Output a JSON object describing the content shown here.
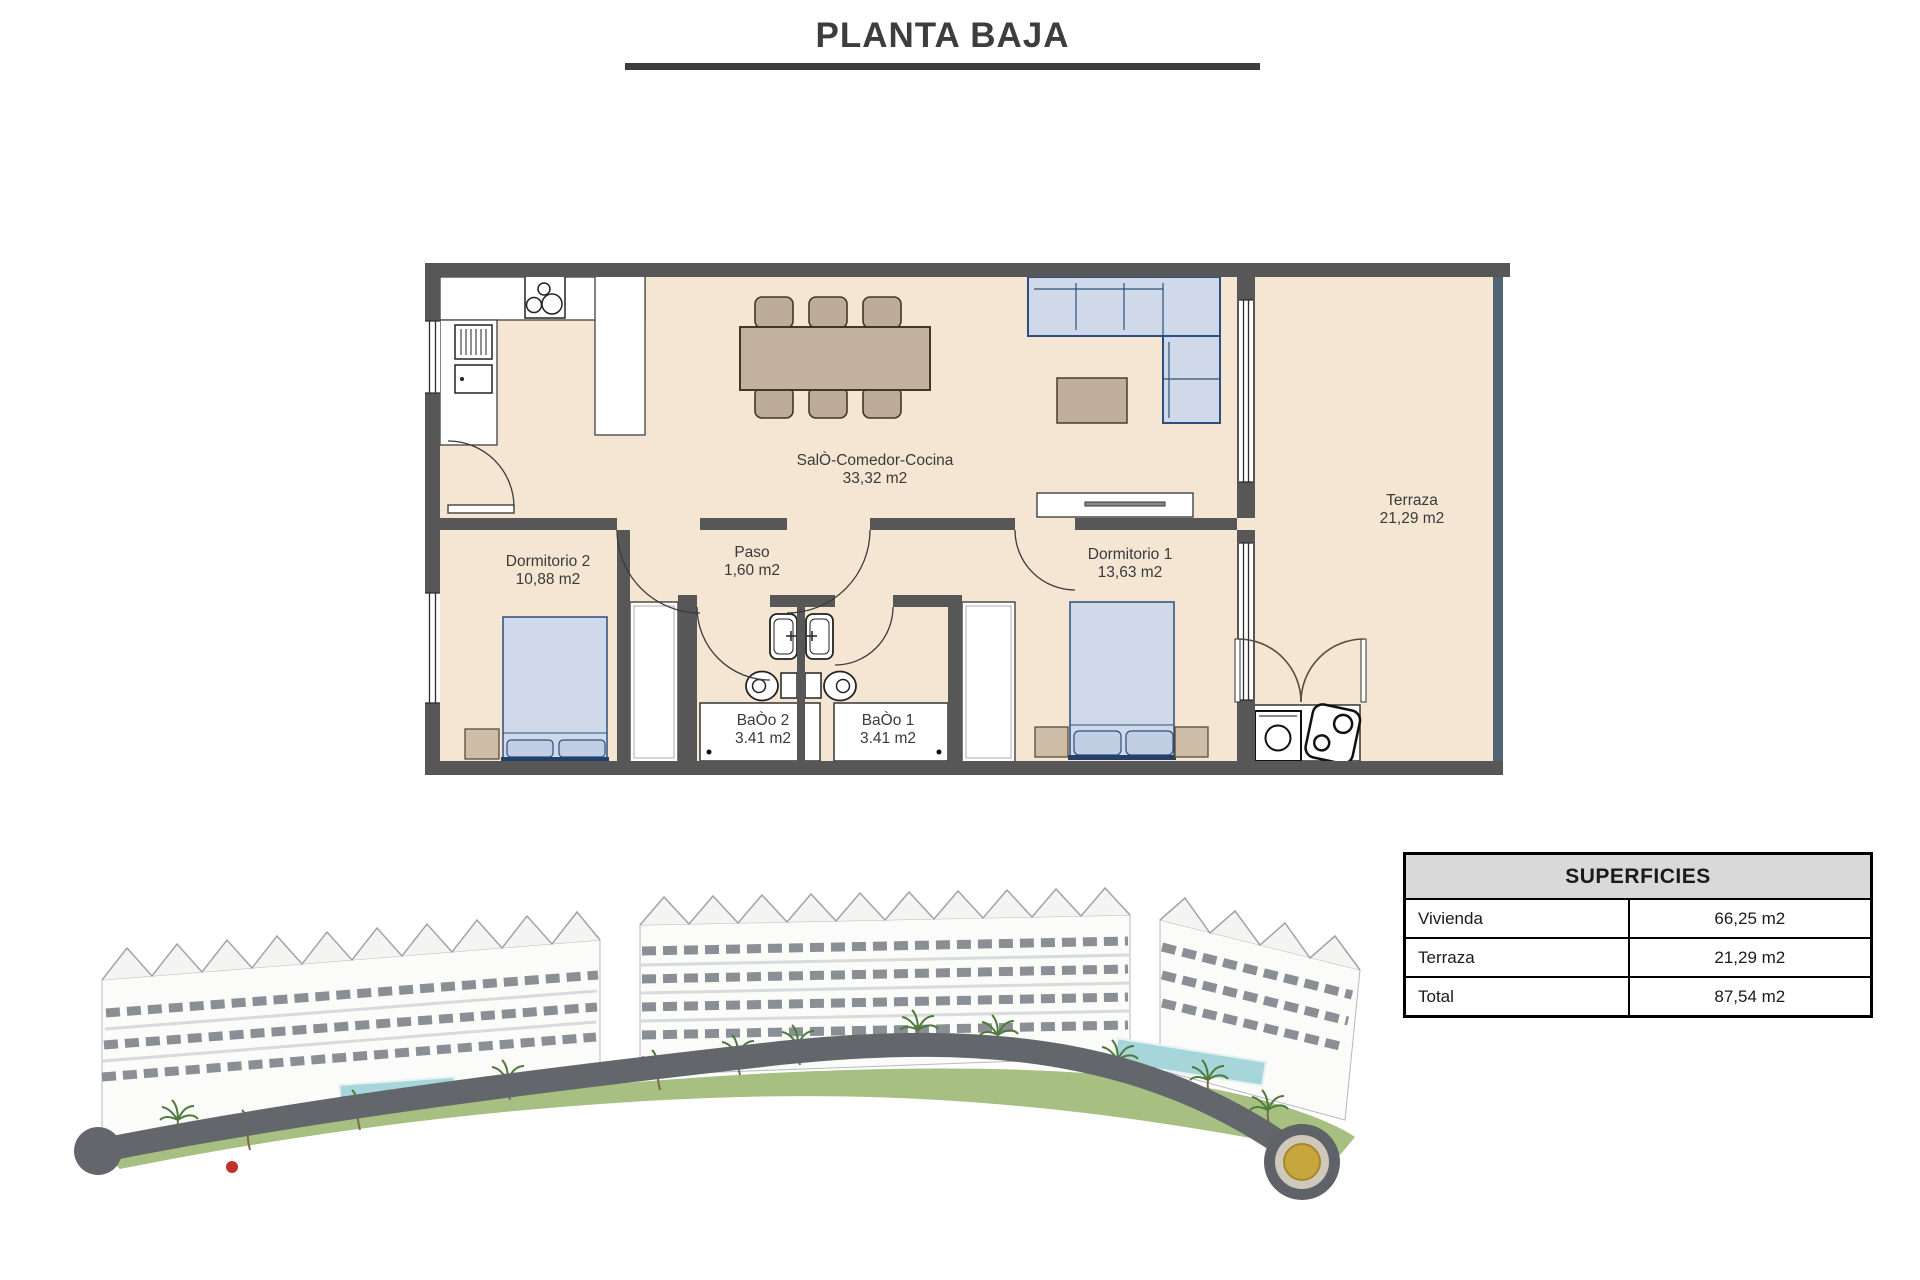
{
  "page": {
    "title": "PLANTA BAJA"
  },
  "floorplan": {
    "rooms": {
      "salon": {
        "name": "SalÒ-Comedor-Cocina",
        "area": "33,32 m2"
      },
      "terraza": {
        "name": "Terraza",
        "area": "21,29 m2"
      },
      "dormitorio2": {
        "name": "Dormitorio 2",
        "area": "10,88 m2"
      },
      "paso": {
        "name": "Paso",
        "area": "1,60 m2"
      },
      "dormitorio1": {
        "name": "Dormitorio 1",
        "area": "13,63 m2"
      },
      "bano2": {
        "name": "BaÒo 2",
        "area": "3.41 m2"
      },
      "bano1": {
        "name": "BaÒo 1",
        "area": "3.41 m2"
      }
    },
    "icons": {
      "stove": "stove-icon",
      "fridge": "fridge-icon",
      "sink": "sink-icon",
      "toilet": "toilet-icon",
      "washing_machine": "washing-machine-icon",
      "boiler": "boiler-icon",
      "door_swing": "door-swing-icon",
      "window": "window-icon"
    },
    "colors": {
      "wall": "#575757",
      "floor": "#f5e6d3",
      "wood_furniture": "#c2b19d",
      "upholstery": "#cfd9e9",
      "upholstery_border": "#2f4e7d",
      "terrace_railing": "#506472"
    }
  },
  "superficies": {
    "title": "SUPERFICIES",
    "rows": [
      {
        "label": "Vivienda",
        "value": "66,25 m2"
      },
      {
        "label": "Terraza",
        "value": "21,29 m2"
      },
      {
        "label": "Total",
        "value": "87,54 m2"
      }
    ]
  },
  "render_colors": {
    "road": "#63676c",
    "lawn": "#9db873",
    "pool": "#a7d6da",
    "roundabout_center": "#c8a63e"
  }
}
